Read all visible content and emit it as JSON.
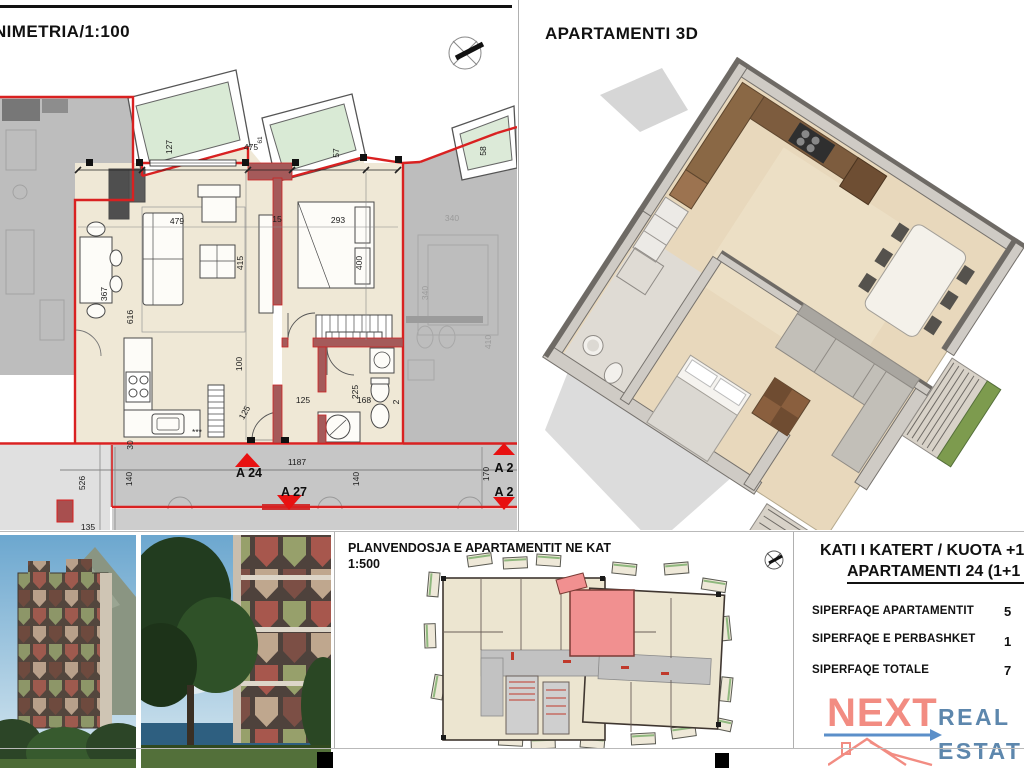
{
  "floorplan_panel": {
    "title": "NIMETRIA/1:100",
    "dim_labels": [
      {
        "t": "127",
        "x": 172,
        "y": 147,
        "r": -90
      },
      {
        "t": "475",
        "x": 251,
        "y": 150,
        "r": 0
      },
      {
        "t": "61",
        "x": 262,
        "y": 140,
        "r": -90,
        "c": "sm"
      },
      {
        "t": "57",
        "x": 339,
        "y": 153,
        "r": -90
      },
      {
        "t": "58",
        "x": 486,
        "y": 151,
        "r": -90
      },
      {
        "t": "479",
        "x": 177,
        "y": 224,
        "r": 0
      },
      {
        "t": "15",
        "x": 277,
        "y": 222,
        "r": 0
      },
      {
        "t": "293",
        "x": 338,
        "y": 223,
        "r": 0
      },
      {
        "t": "415",
        "x": 243,
        "y": 263,
        "r": -90
      },
      {
        "t": "400",
        "x": 362,
        "y": 263,
        "r": -90
      },
      {
        "t": "616",
        "x": 133,
        "y": 317,
        "r": -90
      },
      {
        "t": "367",
        "x": 107,
        "y": 294,
        "r": -90
      },
      {
        "t": "100",
        "x": 242,
        "y": 364,
        "r": -90
      },
      {
        "t": "125",
        "x": 247,
        "y": 414,
        "r": -60
      },
      {
        "t": "125",
        "x": 303,
        "y": 403,
        "r": 0
      },
      {
        "t": "225",
        "x": 358,
        "y": 392,
        "r": -90
      },
      {
        "t": "168",
        "x": 364,
        "y": 403,
        "r": 0
      },
      {
        "t": "2",
        "x": 399,
        "y": 402,
        "r": -90
      },
      {
        "t": "30",
        "x": 133,
        "y": 445,
        "r": -90
      },
      {
        "t": "***",
        "x": 197,
        "y": 435,
        "r": 0
      },
      {
        "t": "526",
        "x": 85,
        "y": 483,
        "r": -90
      },
      {
        "t": "140",
        "x": 132,
        "y": 479,
        "r": -90
      },
      {
        "t": "1187",
        "x": 297,
        "y": 465,
        "r": 0
      },
      {
        "t": "140",
        "x": 359,
        "y": 479,
        "r": -90
      },
      {
        "t": "170",
        "x": 489,
        "y": 474,
        "r": -90
      },
      {
        "t": "135",
        "x": 88,
        "y": 530,
        "r": 0
      },
      {
        "t": "340",
        "x": 452,
        "y": 221,
        "r": 0,
        "c": "g"
      },
      {
        "t": "340",
        "x": 428,
        "y": 293,
        "r": -90,
        "c": "g"
      },
      {
        "t": "410",
        "x": 491,
        "y": 342,
        "r": -90,
        "c": "g"
      },
      {
        "t": "A 24",
        "x": 249,
        "y": 477,
        "r": 0,
        "c": "z"
      },
      {
        "t": "A 27",
        "x": 294,
        "y": 496,
        "r": 0,
        "c": "z"
      },
      {
        "t": "A 2",
        "x": 504,
        "y": 472,
        "r": 0,
        "c": "z"
      },
      {
        "t": "A 2",
        "x": 504,
        "y": 496,
        "r": 0,
        "c": "z"
      }
    ]
  },
  "apartment3d_panel": {
    "title": "APARTAMENTI 3D"
  },
  "keyplan_panel": {
    "title": "PLANVENDOSJA E APARTAMENTIT NE KAT",
    "scale": "1:500"
  },
  "info_panel": {
    "line1": "KATI I KATERT / KUOTA +1",
    "line2": "APARTAMENTI 24 (1+1",
    "rows": [
      {
        "label": "SIPERFAQE APARTAMENTIT",
        "value": "5"
      },
      {
        "label": "SIPERFAQE E PERBASHKET",
        "value": "1"
      },
      {
        "label": "SIPERFAQE TOTALE",
        "value": "7"
      }
    ],
    "logo": {
      "word1": "NEXT",
      "word2": "REAL",
      "word3": "ESTATE"
    }
  },
  "colors": {
    "wall_red": "#d92121",
    "wall_fill": "#a55a5a",
    "floor_beige": "#efe8d6",
    "neighbor_gray": "#bdbdbd",
    "corridor_gray": "#c6c6c6",
    "balcony_green": "#d9ead5",
    "highlight_pink": "#f19090",
    "logo_coral": "#f28c82",
    "logo_blue": "#5d87ad",
    "arrow_blue": "#5b8fc9",
    "planter_green": "#7d9b4e"
  }
}
